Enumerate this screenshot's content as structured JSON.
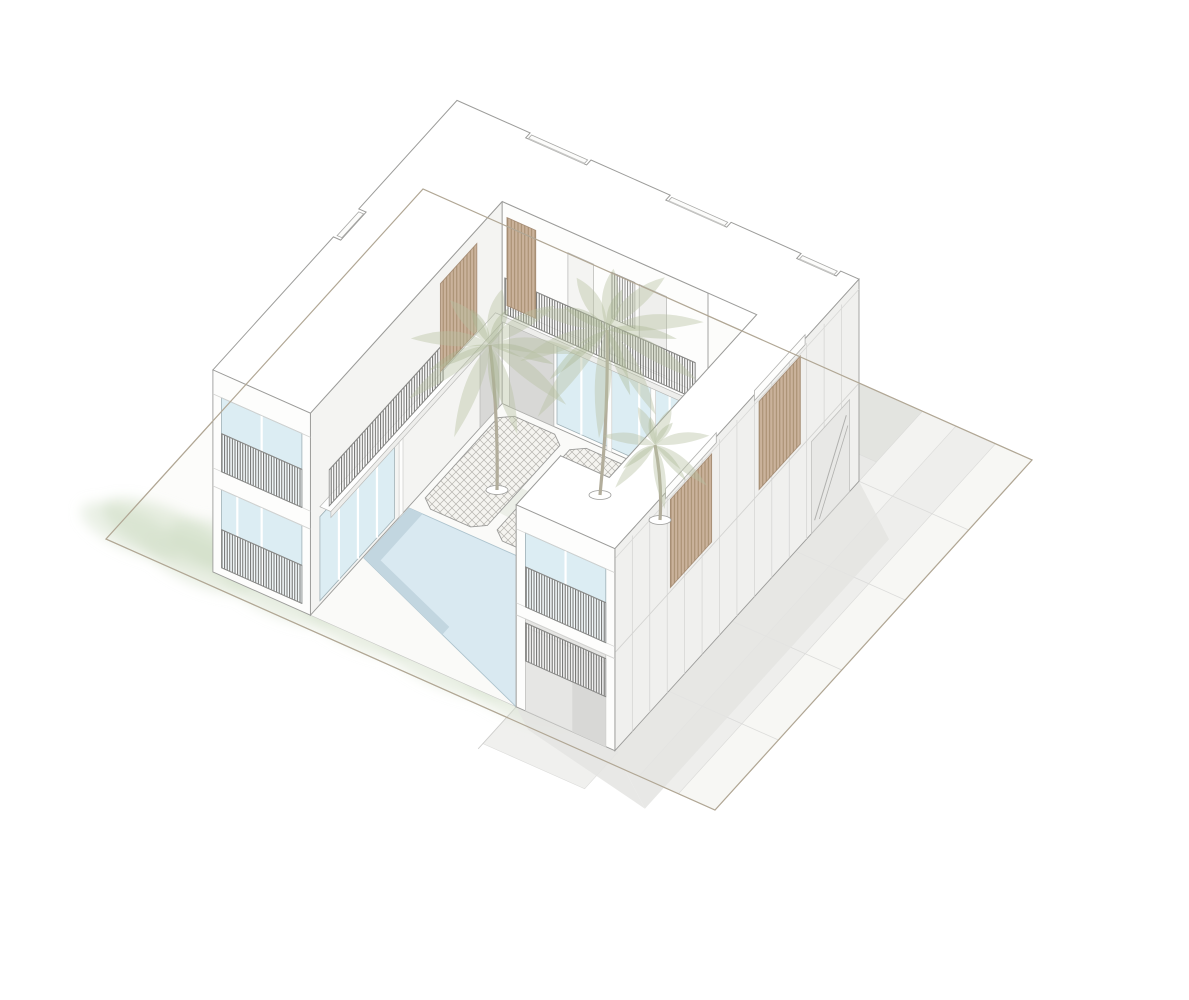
{
  "scene": {
    "type": "architectural-axonometric-drawing",
    "subject": "two-storey U-shaped courtyard villa with swimming pool, lattice paving, palm trees and timber slat screens",
    "stories": 2,
    "palm_trees": 3,
    "roof_skylights": 4,
    "timber_screens": 4,
    "lattice_paving_panels": 3,
    "balcony_railings": 6,
    "pool_present": true
  },
  "colors": {
    "bg": "#ffffff",
    "line": "#9c9c9a",
    "siteLine": "#b1a795",
    "siteFill": "#fcfcfa",
    "groundA": "#f7f7f4",
    "groundB": "#eeeeec",
    "groundC": "#f3f3f1",
    "groundD": "#e3e4e0",
    "groundE": "#f6f6f3",
    "groundF": "#e9e9e7",
    "bandLine": "#dcdcda",
    "shadow": "#e4e4e2",
    "veg1": "#d8e3d0",
    "veg2": "#c6d6ba",
    "wall": "#fdfdfc",
    "wallShade": "#f0f0ee",
    "wallInner": "#f4f4f2",
    "panelLine": "#d3d3d1",
    "roof": "#ffffff",
    "terrace": "#fefefe",
    "glass": "#dcedf3",
    "glassLine": "#9fb0b6",
    "wood": "#cab29b",
    "woodLine": "#a8907a",
    "pool": "#d9e9f1",
    "poolShade": "#c2d6e0",
    "poolLine": "#adc3cd",
    "lattice": "#f5f4f0",
    "latticeLine": "#b6b4af",
    "railLine": "#8a8a88",
    "dark": "#d8d8d6",
    "recess": "#e6e6e4",
    "slabEdge": "#eeeeec",
    "benchTop": "#cbb49e",
    "benchSide": "#b9a189",
    "trunk": "#b2ad9b",
    "palm1": "#b7c1a1",
    "palm2": "#a9b591",
    "skylight": "#fcfcfb"
  }
}
